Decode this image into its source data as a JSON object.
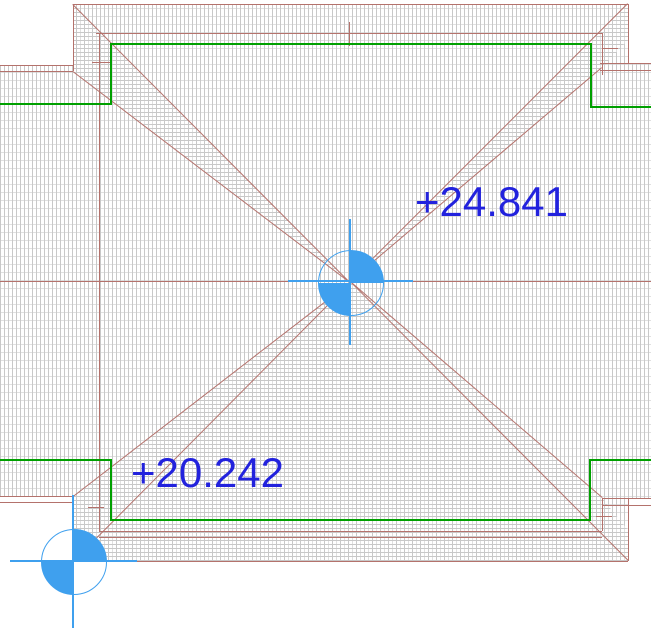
{
  "annotations": {
    "upper_elevation": "+24.841",
    "lower_elevation": "+20.242"
  },
  "markers": {
    "center": {
      "icon": "spot-elevation-icon"
    },
    "corner": {
      "icon": "spot-elevation-icon"
    }
  },
  "colors": {
    "roof_edge": "#b4726c",
    "boundary": "#00a000",
    "marker_blue": "#3fa0ee",
    "text_blue": "#2222dd",
    "hatch_dense": "#c8c8c8",
    "hatch_light": "#e0e0e0",
    "background": "#ffffff"
  }
}
